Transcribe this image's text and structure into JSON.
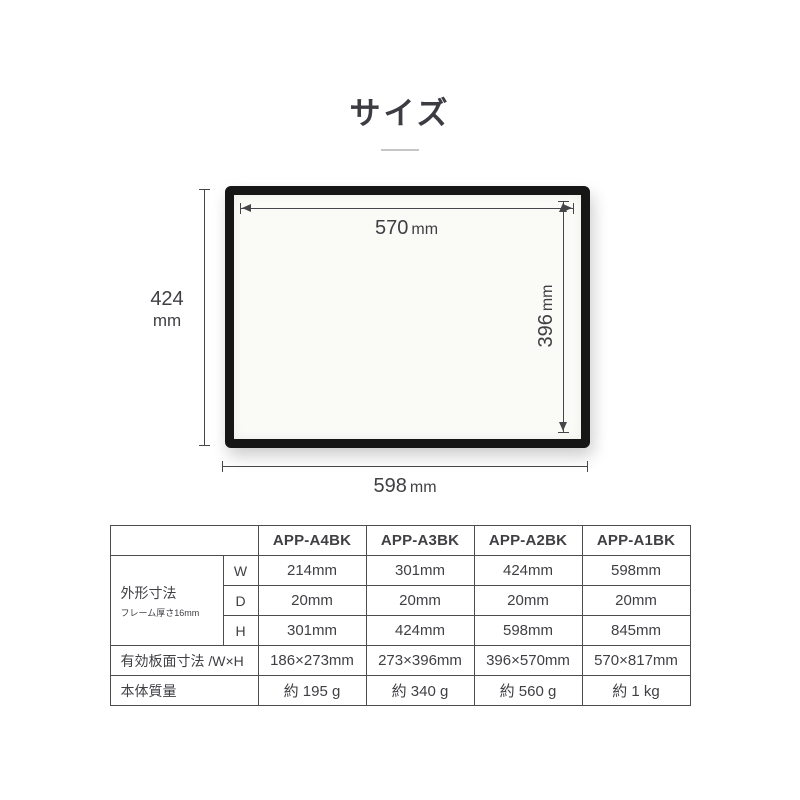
{
  "title": {
    "text": "サイズ"
  },
  "colors": {
    "text": "#3f3f44",
    "dimension_line": "#46464a",
    "frame": "#161616",
    "table_border": "#4d4d4d",
    "title_rule": "#c6c6c6"
  },
  "diagram": {
    "inner_width": {
      "value": "570",
      "unit": "mm"
    },
    "inner_height": {
      "value": "396",
      "unit": "mm"
    },
    "outer_height": {
      "value": "424",
      "unit": "mm"
    },
    "outer_width": {
      "value": "598",
      "unit": "mm"
    }
  },
  "table": {
    "columns": [
      "APP-A4BK",
      "APP-A3BK",
      "APP-A2BK",
      "APP-A1BK"
    ],
    "outer_group": {
      "label": "外形寸法",
      "note": "フレーム厚さ16mm"
    },
    "rows": {
      "w": {
        "label": "W",
        "values": [
          "214mm",
          "301mm",
          "424mm",
          "598mm"
        ]
      },
      "d": {
        "label": "D",
        "values": [
          "20mm",
          "20mm",
          "20mm",
          "20mm"
        ]
      },
      "h": {
        "label": "H",
        "values": [
          "301mm",
          "424mm",
          "598mm",
          "845mm"
        ]
      },
      "board": {
        "label": "有効板面寸法 /W×H",
        "values": [
          "186×273mm",
          "273×396mm",
          "396×570mm",
          "570×817mm"
        ]
      },
      "weight": {
        "label": "本体質量",
        "values": [
          "約 195 g",
          "約 340 g",
          "約 560 g",
          "約 1 kg"
        ]
      }
    }
  }
}
